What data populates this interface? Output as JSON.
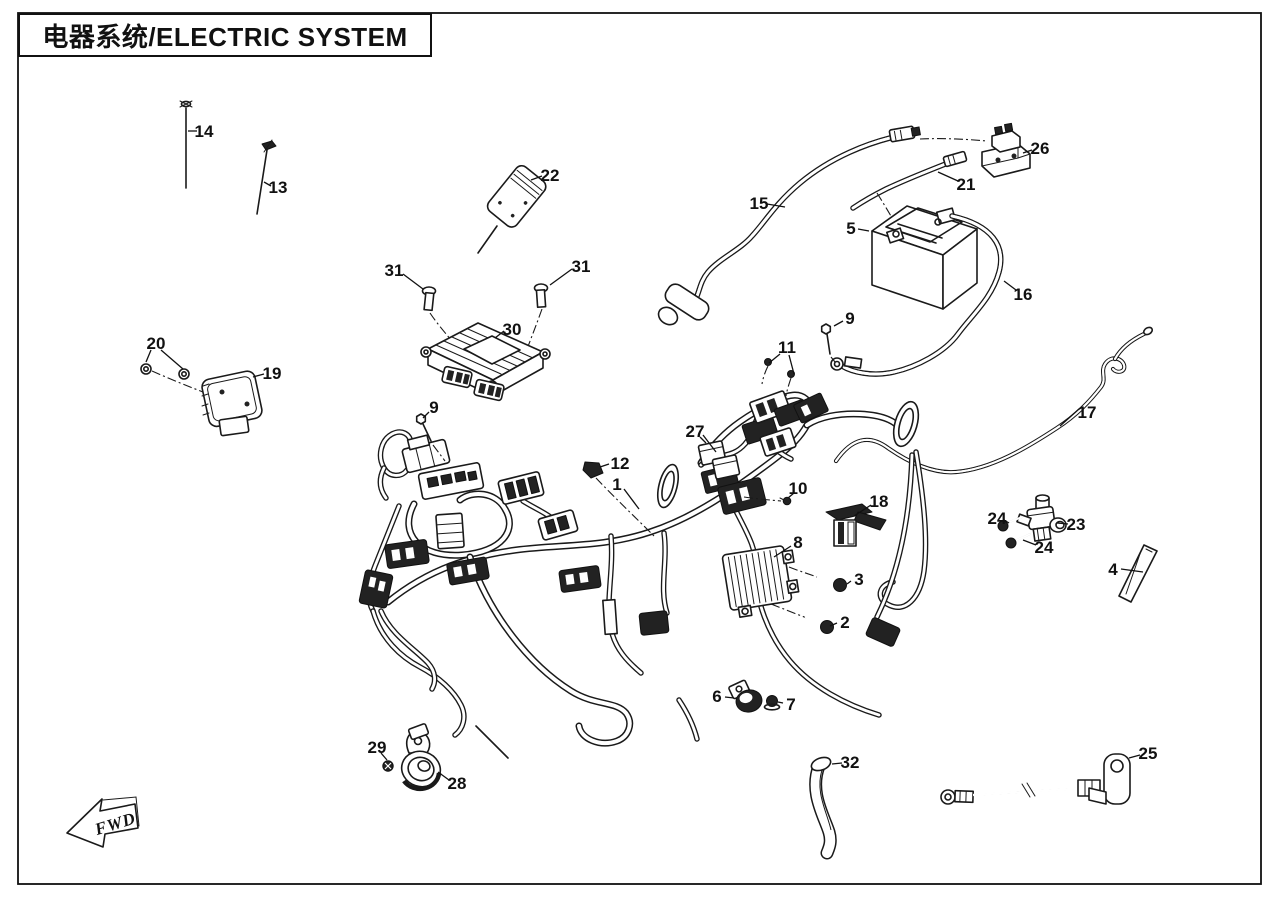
{
  "page": {
    "title": "电器系统/ELECTRIC SYSTEM",
    "fwd_label": "FWD",
    "background_color": "#ffffff",
    "line_color": "#1a1a1a"
  },
  "diagram": {
    "type": "exploded-parts-diagram",
    "subject": "Electric system exploded view with numbered part callouts",
    "callouts": [
      {
        "number": "1",
        "x": 617,
        "y": 484,
        "leaders": [
          [
            624,
            489,
            639,
            509
          ]
        ]
      },
      {
        "number": "2",
        "x": 845,
        "y": 622,
        "leaders": [
          [
            837,
            623,
            830,
            626
          ]
        ]
      },
      {
        "number": "3",
        "x": 859,
        "y": 579,
        "leaders": [
          [
            851,
            581,
            847,
            584
          ]
        ]
      },
      {
        "number": "4",
        "x": 1113,
        "y": 569,
        "leaders": [
          [
            1121,
            569,
            1143,
            572
          ]
        ]
      },
      {
        "number": "5",
        "x": 851,
        "y": 228,
        "leaders": [
          [
            858,
            229,
            869,
            231
          ]
        ]
      },
      {
        "number": "6",
        "x": 717,
        "y": 696,
        "leaders": [
          [
            725,
            697,
            734,
            698
          ]
        ]
      },
      {
        "number": "7",
        "x": 791,
        "y": 704,
        "leaders": [
          [
            783,
            703,
            778,
            702
          ]
        ]
      },
      {
        "number": "8",
        "x": 798,
        "y": 542,
        "leaders": [
          [
            791,
            546,
            774,
            557
          ]
        ]
      },
      {
        "number": "9",
        "x": 434,
        "y": 407,
        "leaders": [
          [
            429,
            412,
            423,
            418
          ]
        ]
      },
      {
        "number": "9",
        "x": 850,
        "y": 318,
        "leaders": [
          [
            843,
            321,
            834,
            326
          ]
        ]
      },
      {
        "number": "10",
        "x": 798,
        "y": 488,
        "leaders": [
          [
            794,
            493,
            788,
            498
          ]
        ]
      },
      {
        "number": "11",
        "x": 787,
        "y": 347,
        "leaders": [
          [
            780,
            354,
            769,
            363
          ],
          [
            789,
            355,
            794,
            374
          ]
        ]
      },
      {
        "number": "12",
        "x": 620,
        "y": 463,
        "leaders": [
          [
            609,
            464,
            600,
            467
          ]
        ]
      },
      {
        "number": "13",
        "x": 278,
        "y": 187,
        "leaders": [
          [
            271,
            186,
            264,
            182
          ]
        ]
      },
      {
        "number": "14",
        "x": 204,
        "y": 131,
        "leaders": [
          [
            197,
            131,
            188,
            131
          ]
        ]
      },
      {
        "number": "15",
        "x": 759,
        "y": 203,
        "leaders": [
          [
            767,
            204,
            785,
            207
          ]
        ]
      },
      {
        "number": "16",
        "x": 1023,
        "y": 294,
        "leaders": [
          [
            1016,
            290,
            1004,
            281
          ]
        ]
      },
      {
        "number": "17",
        "x": 1087,
        "y": 412,
        "leaders": [
          [
            1079,
            409,
            1060,
            426
          ]
        ]
      },
      {
        "number": "18",
        "x": 879,
        "y": 501,
        "leaders": [
          [
            871,
            505,
            854,
            516
          ]
        ]
      },
      {
        "number": "19",
        "x": 272,
        "y": 373,
        "leaders": [
          [
            264,
            374,
            253,
            377
          ]
        ]
      },
      {
        "number": "20",
        "x": 156,
        "y": 343,
        "leaders": [
          [
            151,
            350,
            146,
            362
          ],
          [
            161,
            350,
            183,
            369
          ]
        ]
      },
      {
        "number": "21",
        "x": 966,
        "y": 184,
        "leaders": [
          [
            958,
            181,
            938,
            172
          ]
        ]
      },
      {
        "number": "22",
        "x": 550,
        "y": 175,
        "leaders": [
          [
            542,
            176,
            531,
            180
          ]
        ]
      },
      {
        "number": "23",
        "x": 1076,
        "y": 524,
        "leaders": [
          [
            1068,
            524,
            1057,
            523
          ]
        ]
      },
      {
        "number": "24",
        "x": 997,
        "y": 518,
        "leaders": [
          [
            1004,
            520,
            1009,
            523
          ]
        ]
      },
      {
        "number": "24",
        "x": 1044,
        "y": 547,
        "leaders": [
          [
            1036,
            545,
            1023,
            540
          ]
        ]
      },
      {
        "number": "25",
        "x": 1148,
        "y": 753,
        "leaders": [
          [
            1140,
            755,
            1129,
            758
          ]
        ]
      },
      {
        "number": "26",
        "x": 1040,
        "y": 148,
        "leaders": [
          [
            1032,
            150,
            1023,
            153
          ]
        ]
      },
      {
        "number": "27",
        "x": 695,
        "y": 431,
        "leaders": [
          [
            700,
            437,
            706,
            443
          ],
          [
            703,
            435,
            716,
            452
          ]
        ]
      },
      {
        "number": "28",
        "x": 457,
        "y": 783,
        "leaders": [
          [
            449,
            780,
            438,
            772
          ]
        ]
      },
      {
        "number": "29",
        "x": 377,
        "y": 747,
        "leaders": [
          [
            381,
            753,
            387,
            760
          ]
        ]
      },
      {
        "number": "30",
        "x": 512,
        "y": 329,
        "leaders": [
          [
            504,
            331,
            495,
            338
          ]
        ]
      },
      {
        "number": "31",
        "x": 394,
        "y": 270,
        "leaders": [
          [
            403,
            274,
            423,
            289
          ]
        ]
      },
      {
        "number": "31",
        "x": 581,
        "y": 266,
        "leaders": [
          [
            572,
            269,
            550,
            285
          ]
        ]
      },
      {
        "number": "32",
        "x": 850,
        "y": 762,
        "leaders": [
          [
            842,
            763,
            832,
            764
          ]
        ]
      }
    ]
  }
}
